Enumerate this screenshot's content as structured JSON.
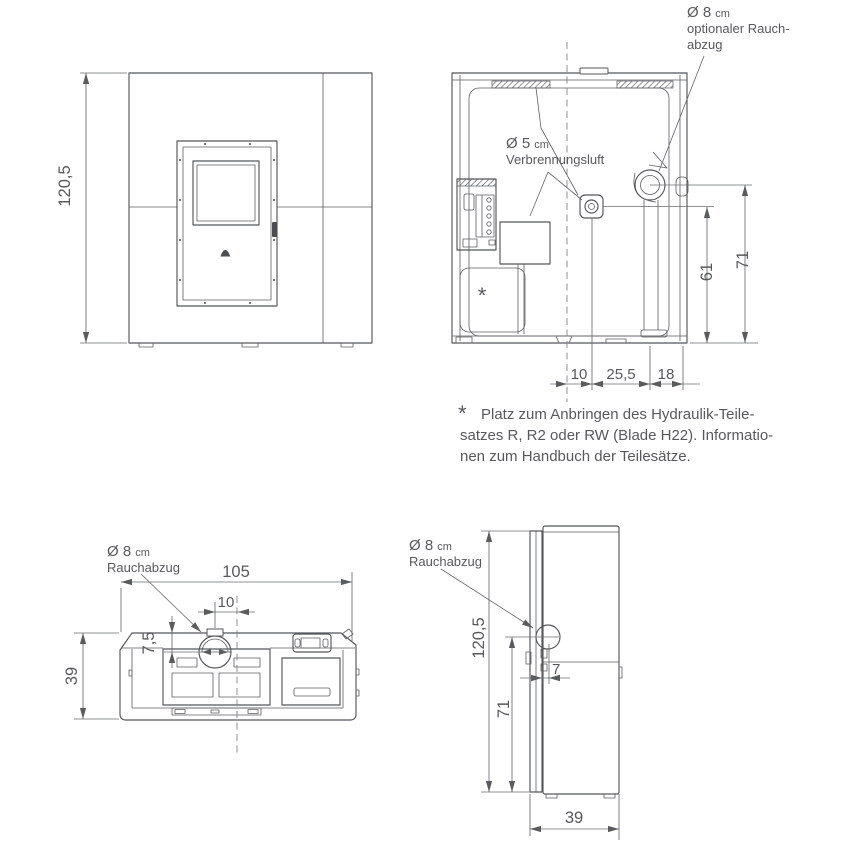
{
  "colors": {
    "line": "#55565a",
    "text": "#58595c",
    "background": "#ffffff"
  },
  "front": {
    "height": "120,5"
  },
  "rear": {
    "flue_dia": "Ø 8",
    "flue_unit": "cm",
    "flue_l2": "optionaler Rauch-",
    "flue_l3": "abzug",
    "air_dia": "Ø 5",
    "air_unit": "cm",
    "air_l2": "Verbrennungsluft",
    "dim_61": "61",
    "dim_71": "71",
    "dim_10": "10",
    "dim_25": "25,5",
    "dim_18": "18",
    "asterisk": "*"
  },
  "footnote": {
    "marker": "*",
    "line1": "Platz zum Anbringen des Hydraulik-Teile-",
    "line2": "satzes R, R2 oder RW (Blade H22). Informatio-",
    "line3": "nen zum Handbuch der Teilesätze."
  },
  "top": {
    "flue_dia": "Ø 8",
    "flue_unit": "cm",
    "flue_l2": "Rauchabzug",
    "dim_105": "105",
    "dim_10": "10",
    "dim_75": "7,5",
    "dim_39": "39"
  },
  "side": {
    "flue_dia": "Ø 8",
    "flue_unit": "cm",
    "flue_l2": "Rauchabzug",
    "dim_height": "120,5",
    "dim_71": "71",
    "dim_7": "7",
    "dim_39": "39"
  }
}
